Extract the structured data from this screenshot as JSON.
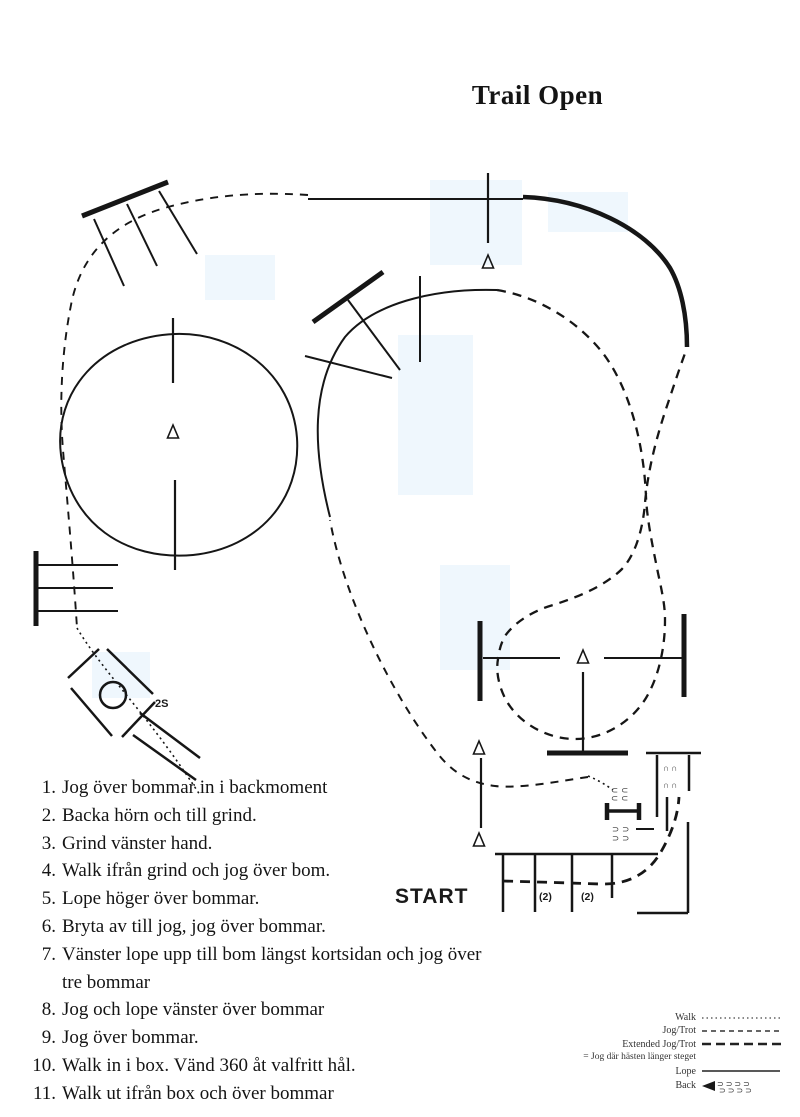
{
  "title": "Trail Open",
  "course": {
    "start_label": "START",
    "box_label": "2S",
    "pole_spacing_labels": [
      "(2)",
      "(2)"
    ],
    "hoofprints": {
      "chute_row": "∩∩",
      "gate_upper_row": "⊂⊂",
      "gate_lower_row": "⊃⊃"
    }
  },
  "instructions": [
    {
      "num": "1.",
      "text": "Jog över bommar in i backmoment"
    },
    {
      "num": "2.",
      "text": "Backa hörn och till grind."
    },
    {
      "num": "3.",
      "text": "Grind vänster hand."
    },
    {
      "num": "4.",
      "text": "Walk ifrån grind och jog över bom."
    },
    {
      "num": "5.",
      "text": "Lope höger över bommar."
    },
    {
      "num": "6.",
      "text": "Bryta av till jog, jog över bommar."
    },
    {
      "num": "7.",
      "text": "Vänster lope upp till bom längst kortsidan och jog över",
      "text2": "tre bommar"
    },
    {
      "num": "8.",
      "text": "Jog och lope vänster över bommar"
    },
    {
      "num": "9.",
      "text": "Jog över bommar."
    },
    {
      "num": "10.",
      "text": "Walk in i box. Vänd 360 åt valfritt hål."
    },
    {
      "num": "11.",
      "text": "Walk ut ifrån box och över bommar"
    }
  ],
  "legend": {
    "walk": "Walk",
    "jog": "Jog/Trot",
    "extended_jog": "Extended Jog/Trot",
    "note": "= Jog där hästen länger steget",
    "lope": "Lope",
    "back": "Back",
    "back_prints_row": "⊃⊃⊃⊃"
  },
  "colors": {
    "ink": "#161616",
    "background": "#ffffff"
  }
}
